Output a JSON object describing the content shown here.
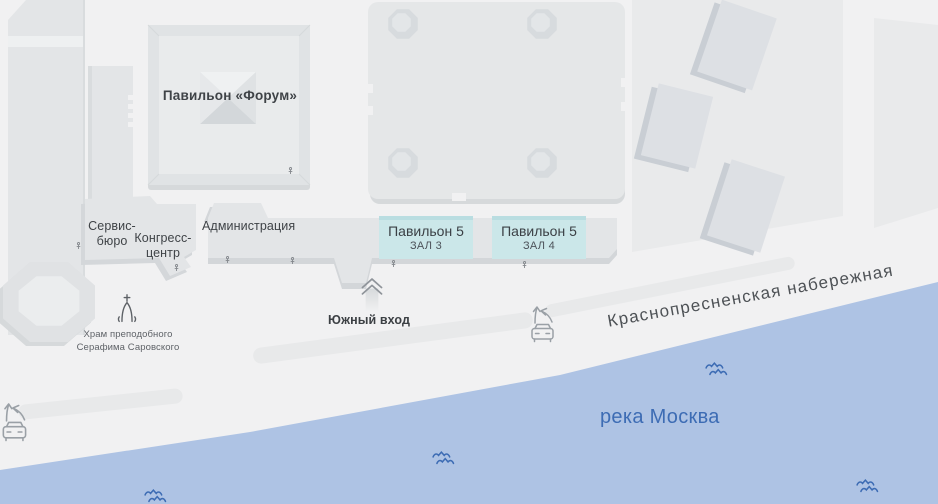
{
  "buildings": {
    "forum": {
      "label": "Павильон «Форум»"
    },
    "service_bureau": {
      "line1": "Сервис-",
      "line2": "бюро"
    },
    "congress_center": {
      "line1": "Конгресс-",
      "line2": "центр"
    },
    "administration": {
      "label": "Администрация"
    },
    "halls": [
      {
        "title": "Павильон 5",
        "subtitle": "ЗАЛ 3"
      },
      {
        "title": "Павильон 5",
        "subtitle": "ЗАЛ 4"
      }
    ]
  },
  "landmarks": {
    "south_entrance": {
      "label": "Южный вход"
    },
    "church": {
      "line1": "Храм преподобного",
      "line2": "Серафима Саровского"
    }
  },
  "streets": {
    "embankment": {
      "label": "Краснопресненская набережная"
    }
  },
  "water": {
    "river": {
      "label": "река Москва"
    }
  },
  "icons": {
    "church-icon": "onion-dome-with-cross outline",
    "south-entrance-arrow-icon": "double-chevron-up with fading trail",
    "car-entrance-icon": "car front with curved entry arrows",
    "waves-icon": "two wavy water lines",
    "entrance-marker-icon": "tiny door/entrance marker"
  },
  "colors": {
    "background": "#f1f1f2",
    "building": "#e3e5e7",
    "building_inner": "#e9ebec",
    "building_shadow": "#d3d6d9",
    "district": "#e9eaeb",
    "highlight_fill": "#cbe7e9",
    "highlight_border": "#b9dde1",
    "water": "#aec3e4",
    "water_text": "#3d6cb4",
    "label_text": "#3f4347",
    "street_text": "#4e5256",
    "icon_gray": "#9aa0a6"
  }
}
